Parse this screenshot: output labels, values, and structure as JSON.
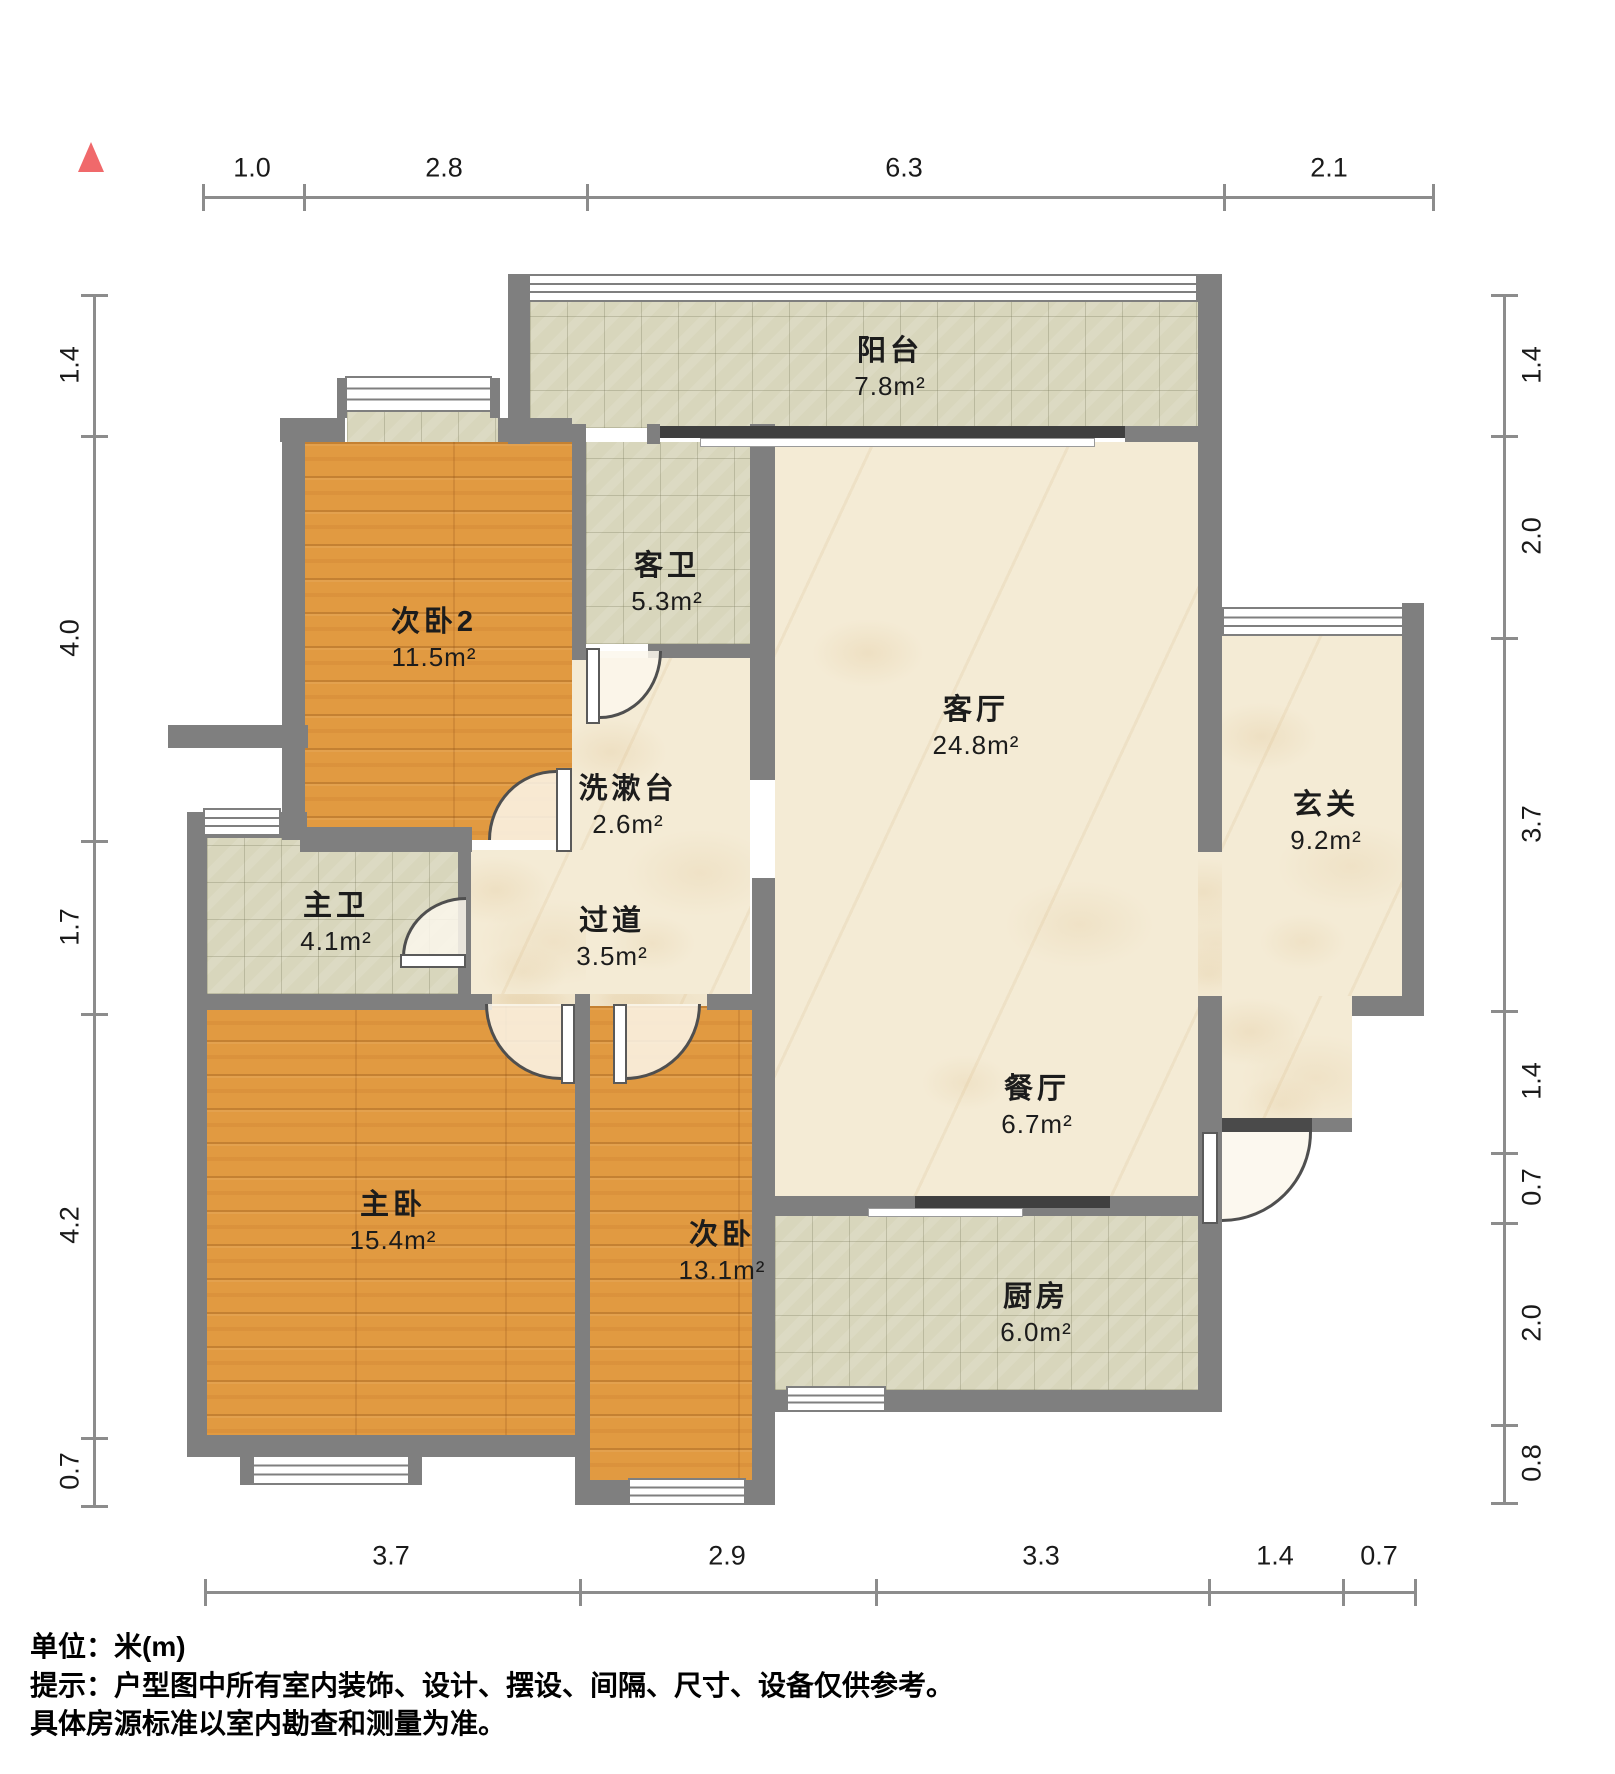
{
  "rooms": [
    {
      "name": "阳台",
      "area": "7.8m²"
    },
    {
      "name": "次卧2",
      "area": "11.5m²"
    },
    {
      "name": "客卫",
      "area": "5.3m²"
    },
    {
      "name": "客厅",
      "area": "24.8m²"
    },
    {
      "name": "玄关",
      "area": "9.2m²"
    },
    {
      "name": "洗漱台",
      "area": "2.6m²"
    },
    {
      "name": "主卫",
      "area": "4.1m²"
    },
    {
      "name": "过道",
      "area": "3.5m²"
    },
    {
      "name": "餐厅",
      "area": "6.7m²"
    },
    {
      "name": "主卧",
      "area": "15.4m²"
    },
    {
      "name": "次卧",
      "area": "13.1m²"
    },
    {
      "name": "厨房",
      "area": "6.0m²"
    }
  ],
  "dimensions": {
    "top": [
      "1.0",
      "2.8",
      "6.3",
      "2.1"
    ],
    "bottom": [
      "3.7",
      "2.9",
      "3.3",
      "1.4",
      "0.7"
    ],
    "left": [
      "1.4",
      "4.0",
      "1.7",
      "4.2",
      "0.7"
    ],
    "right": [
      "1.4",
      "2.0",
      "3.7",
      "1.4",
      "0.7",
      "2.0",
      "0.8"
    ]
  },
  "footer": {
    "unit": "单位：米(m)",
    "note1": "提示：户型图中所有室内装饰、设计、摆设、间隔、尺寸、设备仅供参考。",
    "note2": "具体房源标准以室内勘查和测量为准。"
  },
  "colors": {
    "wall": "#7f7f7f",
    "wood": "#e19a41",
    "tile": "#d8d6bc",
    "marble": "#f4ebd5",
    "compass": "#f0696b",
    "slide": "#3f3f3f",
    "dim": "#8c8c8c",
    "text": "#1c1c1c"
  }
}
